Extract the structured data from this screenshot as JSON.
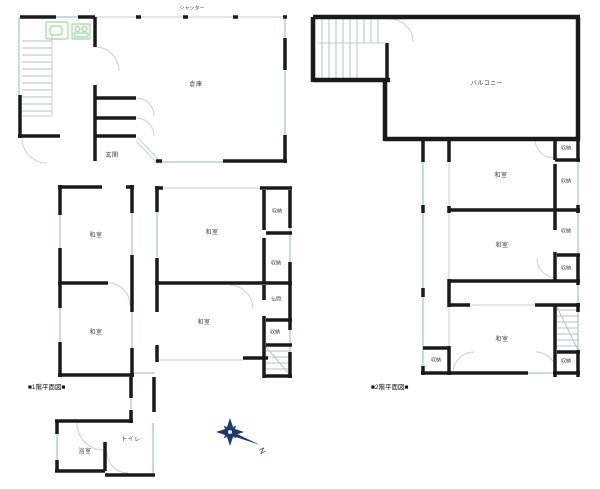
{
  "colors": {
    "wall": "#1a1a1a",
    "window_line": "#c8dae4",
    "thin_line": "#c9ced4",
    "fixture_green": "#9fd89f",
    "compass_navy": "#1f3a68",
    "label_text": "#3c3c3c",
    "background": "#ffffff"
  },
  "plan1": {
    "title": "■1階平面図■",
    "labels": {
      "shutter": "シャッター",
      "warehouse": "倉庫",
      "entrance": "玄関",
      "washitsu_nw": "和室",
      "washitsu_ne": "和室",
      "washitsu_sw": "和室",
      "washitsu_s": "和室",
      "closet_a": "収納",
      "closet_b": "収納",
      "butsuma": "仏間",
      "closet_c": "収納",
      "bath": "浴室",
      "toilet": "トイレ"
    }
  },
  "plan2": {
    "title": "■2階平面図■",
    "labels": {
      "balcony": "バルコニー",
      "washitsu_1": "和室",
      "washitsu_2": "和室",
      "washitsu_3": "和室",
      "closet_a": "収納",
      "closet_b": "収納",
      "closet_c": "収納",
      "closet_d": "収納",
      "closet_e": "収納",
      "closet_f": "収納"
    }
  },
  "compass": {
    "north": "N"
  }
}
